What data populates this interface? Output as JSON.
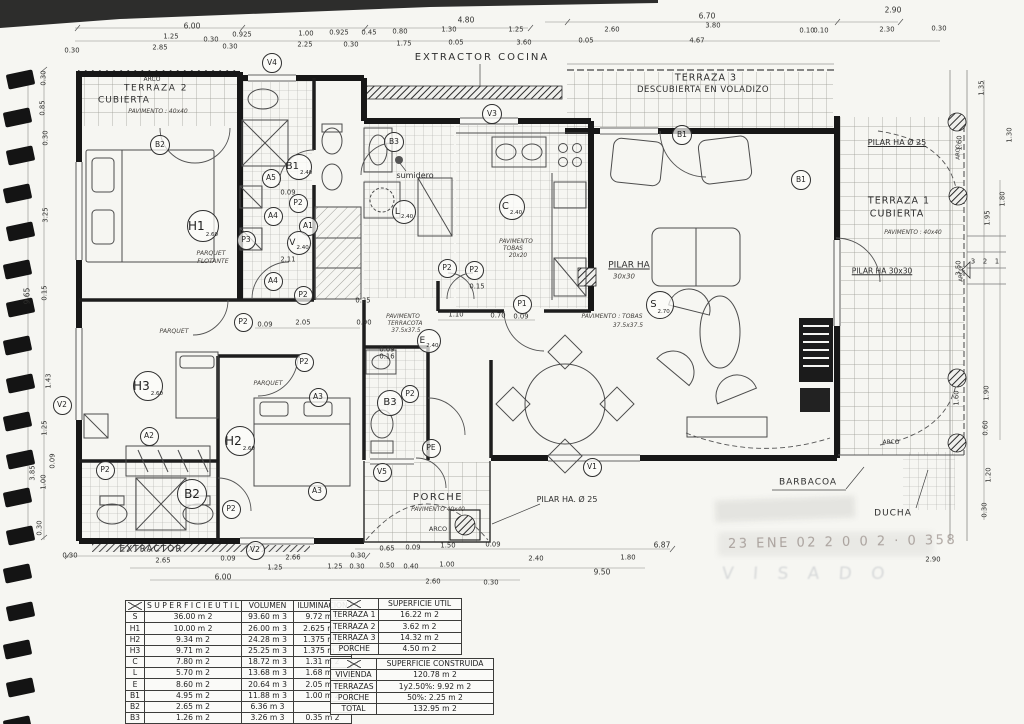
{
  "colors": {
    "paper": "#f6f6f2",
    "ink": "#2a2a2a",
    "stamp_date": "#857872",
    "stamp_visado": "#808896"
  },
  "stamp": {
    "line1": "23 ENE 02  2 0 0 2 · 0 358",
    "line2": "V I S A D O"
  },
  "plan": {
    "labels": [
      {
        "t": "ARCO",
        "x": 152,
        "y": 80,
        "s": 6
      },
      {
        "t": "TERRAZA 2",
        "x": 156,
        "y": 89,
        "s": 9,
        "sp": 1.5
      },
      {
        "t": "CUBIERTA",
        "x": 124,
        "y": 101,
        "s": 9,
        "sp": 1
      },
      {
        "t": "PAVIMENTO : 40x40",
        "x": 158,
        "y": 112,
        "s": 6,
        "i": 1
      },
      {
        "t": "EXTRACTOR COCINA",
        "x": 482,
        "y": 58,
        "s": 10,
        "sp": 2
      },
      {
        "t": "TERRAZA 3",
        "x": 706,
        "y": 78,
        "s": 9.5,
        "sp": 1
      },
      {
        "t": "DESCUBIERTA EN VOLADIZO",
        "x": 703,
        "y": 90,
        "s": 8.5,
        "sp": 0.5
      },
      {
        "t": "PILAR HA Ø 25",
        "x": 897,
        "y": 143,
        "s": 8,
        "u": 1
      },
      {
        "t": "TERRAZA 1",
        "x": 899,
        "y": 201,
        "s": 9.5,
        "sp": 1
      },
      {
        "t": "CUBIERTA",
        "x": 897,
        "y": 214,
        "s": 9.5,
        "sp": 1
      },
      {
        "t": "PAVIMENTO : 40x40",
        "x": 913,
        "y": 234,
        "s": 5.8,
        "i": 1
      },
      {
        "t": "PILAR HA 30x30",
        "x": 882,
        "y": 271,
        "s": 7.5,
        "u": 1
      },
      {
        "t": "PILAR HA",
        "x": 629,
        "y": 266,
        "s": 9,
        "u": 1
      },
      {
        "t": "30x30",
        "x": 624,
        "y": 277,
        "s": 7,
        "i": 1
      },
      {
        "t": "PAVIMENTO : TOBAS",
        "x": 612,
        "y": 317,
        "s": 6,
        "i": 1
      },
      {
        "t": "37.5x37.5",
        "x": 628,
        "y": 326,
        "s": 6,
        "i": 1
      },
      {
        "t": "sumidero",
        "x": 415,
        "y": 176,
        "s": 8
      },
      {
        "t": "PARQUET",
        "x": 211,
        "y": 254,
        "s": 6.2,
        "i": 1
      },
      {
        "t": "FLOTANTE",
        "x": 213,
        "y": 262,
        "s": 6.2,
        "i": 1
      },
      {
        "t": "PARQUET",
        "x": 174,
        "y": 332,
        "s": 6.2,
        "i": 1
      },
      {
        "t": "PARQUET",
        "x": 268,
        "y": 384,
        "s": 6.2,
        "i": 1
      },
      {
        "t": "PAVIMENTO",
        "x": 403,
        "y": 318,
        "s": 5.8,
        "i": 1
      },
      {
        "t": "TERRACOTA",
        "x": 405,
        "y": 325,
        "s": 5.8,
        "i": 1
      },
      {
        "t": "37.5x37.5",
        "x": 406,
        "y": 332,
        "s": 5.8,
        "i": 1
      },
      {
        "t": "PAVIMENTO",
        "x": 516,
        "y": 243,
        "s": 5.8,
        "i": 1
      },
      {
        "t": "TOBAS",
        "x": 513,
        "y": 250,
        "s": 5.8,
        "i": 1
      },
      {
        "t": "20x20",
        "x": 518,
        "y": 257,
        "s": 5.8,
        "i": 1
      },
      {
        "t": "EXTRACTOR",
        "x": 151,
        "y": 550,
        "s": 9,
        "sp": 1
      },
      {
        "t": "PORCHE",
        "x": 438,
        "y": 498,
        "s": 10,
        "sp": 1.5
      },
      {
        "t": "PAVIMENTO  40x40",
        "x": 438,
        "y": 511,
        "s": 5.8,
        "i": 1
      },
      {
        "t": "ARCO",
        "x": 438,
        "y": 529,
        "s": 6.5
      },
      {
        "t": "PILAR HA. Ø 25",
        "x": 567,
        "y": 500,
        "s": 8
      },
      {
        "t": "BARBACOA",
        "x": 808,
        "y": 483,
        "s": 9,
        "sp": 1
      },
      {
        "t": "DUCHA",
        "x": 893,
        "y": 514,
        "s": 9,
        "sp": 1
      },
      {
        "t": "ARCO",
        "x": 891,
        "y": 443,
        "s": 6
      },
      {
        "t": "ARCO",
        "x": 959,
        "y": 152,
        "s": 5.5,
        "r": 1
      },
      {
        "t": "ARCO",
        "x": 962,
        "y": 274,
        "s": 5.5,
        "r": 1
      },
      {
        "t": "3",
        "x": 973,
        "y": 262,
        "s": 7
      },
      {
        "t": "2",
        "x": 985,
        "y": 262,
        "s": 7
      },
      {
        "t": "1",
        "x": 997,
        "y": 262,
        "s": 7
      }
    ],
    "circles": [
      {
        "l": "V4",
        "x": 272,
        "y": 63,
        "d": 20
      },
      {
        "l": "V3",
        "x": 492,
        "y": 114,
        "d": 20
      },
      {
        "l": "B3",
        "x": 394,
        "y": 142,
        "d": 20
      },
      {
        "l": "B2",
        "x": 160,
        "y": 145,
        "d": 20
      },
      {
        "l": "B1",
        "s": "2.40",
        "x": 299,
        "y": 167,
        "d": 26
      },
      {
        "l": "A5",
        "x": 271,
        "y": 178,
        "d": 19
      },
      {
        "l": "P2",
        "x": 298,
        "y": 203,
        "d": 19
      },
      {
        "l": "A4",
        "x": 273,
        "y": 216,
        "d": 19
      },
      {
        "l": "H1",
        "s": "2.60",
        "x": 203,
        "y": 226,
        "d": 32
      },
      {
        "l": "A1",
        "x": 308,
        "y": 226,
        "d": 19
      },
      {
        "l": "P3",
        "x": 246,
        "y": 240,
        "d": 19
      },
      {
        "l": "V",
        "s": "2.40",
        "x": 299,
        "y": 243,
        "d": 24
      },
      {
        "l": "L",
        "s": "2.40",
        "x": 404,
        "y": 212,
        "d": 24
      },
      {
        "l": "C",
        "s": "2.40",
        "x": 512,
        "y": 207,
        "d": 26
      },
      {
        "l": "A4",
        "x": 273,
        "y": 281,
        "d": 19
      },
      {
        "l": "P2",
        "x": 303,
        "y": 295,
        "d": 19
      },
      {
        "l": "P2",
        "x": 243,
        "y": 322,
        "d": 19
      },
      {
        "l": "P2",
        "x": 447,
        "y": 268,
        "d": 19
      },
      {
        "l": "P2",
        "x": 474,
        "y": 270,
        "d": 19
      },
      {
        "l": "P1",
        "x": 522,
        "y": 304,
        "d": 19
      },
      {
        "l": "S",
        "s": "2.70",
        "x": 660,
        "y": 305,
        "d": 28
      },
      {
        "l": "E",
        "s": "2.40",
        "x": 429,
        "y": 341,
        "d": 24
      },
      {
        "l": "P2",
        "x": 304,
        "y": 362,
        "d": 19
      },
      {
        "l": "A3",
        "x": 318,
        "y": 397,
        "d": 19
      },
      {
        "l": "H3",
        "s": "2.60",
        "x": 148,
        "y": 386,
        "d": 30
      },
      {
        "l": "B3",
        "x": 390,
        "y": 403,
        "d": 26
      },
      {
        "l": "P2",
        "x": 410,
        "y": 394,
        "d": 18
      },
      {
        "l": "H2",
        "s": "2.60",
        "x": 240,
        "y": 441,
        "d": 30
      },
      {
        "l": "A2",
        "x": 149,
        "y": 436,
        "d": 19
      },
      {
        "l": "PE",
        "x": 431,
        "y": 448,
        "d": 19
      },
      {
        "l": "P2",
        "x": 105,
        "y": 470,
        "d": 19
      },
      {
        "l": "A3",
        "x": 317,
        "y": 491,
        "d": 19
      },
      {
        "l": "B2",
        "x": 192,
        "y": 494,
        "d": 30
      },
      {
        "l": "P2",
        "x": 231,
        "y": 509,
        "d": 19
      },
      {
        "l": "V5",
        "x": 382,
        "y": 472,
        "d": 19
      },
      {
        "l": "V1",
        "x": 592,
        "y": 467,
        "d": 19
      },
      {
        "l": "V2",
        "x": 62,
        "y": 405,
        "d": 19
      },
      {
        "l": "V2",
        "x": 255,
        "y": 550,
        "d": 19
      },
      {
        "l": "B1",
        "x": 682,
        "y": 135,
        "d": 20
      },
      {
        "l": "B1",
        "x": 801,
        "y": 180,
        "d": 20
      }
    ]
  },
  "dims": {
    "top": [
      {
        "t": "6.00",
        "x": 192,
        "y": 26,
        "s": 7.5
      },
      {
        "t": "4.80",
        "x": 466,
        "y": 20,
        "s": 7.5
      },
      {
        "t": "6.70",
        "x": 707,
        "y": 16,
        "s": 7.5
      },
      {
        "t": "2.90",
        "x": 893,
        "y": 10,
        "s": 7.5
      },
      {
        "t": "1.25",
        "x": 171,
        "y": 37
      },
      {
        "t": "0.30",
        "x": 211,
        "y": 40
      },
      {
        "t": "0.925",
        "x": 242,
        "y": 35
      },
      {
        "t": "1.00",
        "x": 306,
        "y": 34
      },
      {
        "t": "0.925",
        "x": 339,
        "y": 33
      },
      {
        "t": "0.45",
        "x": 369,
        "y": 33
      },
      {
        "t": "0.80",
        "x": 400,
        "y": 32
      },
      {
        "t": "1.30",
        "x": 449,
        "y": 30
      },
      {
        "t": "1.25",
        "x": 516,
        "y": 30
      },
      {
        "t": "2.60",
        "x": 612,
        "y": 30
      },
      {
        "t": "3.80",
        "x": 713,
        "y": 26
      },
      {
        "t": "0.10",
        "x": 807,
        "y": 31
      },
      {
        "t": "0.10",
        "x": 821,
        "y": 31
      },
      {
        "t": "2.30",
        "x": 887,
        "y": 30
      },
      {
        "t": "0.30",
        "x": 939,
        "y": 29
      },
      {
        "t": "0.30",
        "x": 72,
        "y": 51
      },
      {
        "t": "2.85",
        "x": 160,
        "y": 48
      },
      {
        "t": "0.30",
        "x": 230,
        "y": 47
      },
      {
        "t": "2.25",
        "x": 305,
        "y": 45
      },
      {
        "t": "0.30",
        "x": 351,
        "y": 45
      },
      {
        "t": "1.75",
        "x": 404,
        "y": 44
      },
      {
        "t": "0.05",
        "x": 456,
        "y": 43
      },
      {
        "t": "3.60",
        "x": 524,
        "y": 43
      },
      {
        "t": "0.05",
        "x": 586,
        "y": 41
      },
      {
        "t": "4.67",
        "x": 697,
        "y": 41
      }
    ],
    "bottom": [
      {
        "t": "0.30",
        "x": 70,
        "y": 556
      },
      {
        "t": "2.65",
        "x": 163,
        "y": 561
      },
      {
        "t": "0.09",
        "x": 228,
        "y": 559
      },
      {
        "t": "2.66",
        "x": 293,
        "y": 558
      },
      {
        "t": "0.30",
        "x": 358,
        "y": 556
      },
      {
        "t": "0.65",
        "x": 387,
        "y": 549
      },
      {
        "t": "0.09",
        "x": 413,
        "y": 548
      },
      {
        "t": "1.50",
        "x": 448,
        "y": 546
      },
      {
        "t": "0.09",
        "x": 493,
        "y": 545
      },
      {
        "t": "2.40",
        "x": 536,
        "y": 559
      },
      {
        "t": "1.80",
        "x": 628,
        "y": 558
      },
      {
        "t": "6.87",
        "x": 662,
        "y": 545,
        "s": 7.5
      },
      {
        "t": "1.25",
        "x": 275,
        "y": 568
      },
      {
        "t": "1.25",
        "x": 335,
        "y": 567
      },
      {
        "t": "0.30",
        "x": 357,
        "y": 567
      },
      {
        "t": "0.50",
        "x": 387,
        "y": 566
      },
      {
        "t": "0.40",
        "x": 411,
        "y": 567
      },
      {
        "t": "1.00",
        "x": 447,
        "y": 565
      },
      {
        "t": "9.50",
        "x": 602,
        "y": 572,
        "s": 7.5
      },
      {
        "t": "6.00",
        "x": 223,
        "y": 577,
        "s": 7.5
      },
      {
        "t": "2.60",
        "x": 433,
        "y": 582
      },
      {
        "t": "0.30",
        "x": 491,
        "y": 583
      },
      {
        "t": "2.90",
        "x": 933,
        "y": 560
      }
    ],
    "left": [
      {
        "t": "0.30",
        "x": 44,
        "y": 78
      },
      {
        "t": "0.85",
        "x": 43,
        "y": 108
      },
      {
        "t": "0.30",
        "x": 46,
        "y": 138
      },
      {
        "t": "3.25",
        "x": 46,
        "y": 215
      },
      {
        "t": "0.15",
        "x": 45,
        "y": 293
      },
      {
        "t": "9.65",
        "x": 27,
        "y": 296,
        "s": 7.5
      },
      {
        "t": "1.43",
        "x": 49,
        "y": 381
      },
      {
        "t": "1.25",
        "x": 45,
        "y": 428
      },
      {
        "t": "0.09",
        "x": 53,
        "y": 461
      },
      {
        "t": "3.85",
        "x": 33,
        "y": 473
      },
      {
        "t": "1.00",
        "x": 44,
        "y": 482
      },
      {
        "t": "0.30",
        "x": 40,
        "y": 528
      }
    ],
    "right": [
      {
        "t": "1.35",
        "x": 982,
        "y": 88
      },
      {
        "t": "1.60",
        "x": 960,
        "y": 143
      },
      {
        "t": "1.30",
        "x": 1010,
        "y": 135
      },
      {
        "t": "1.80",
        "x": 1003,
        "y": 199
      },
      {
        "t": "1.95",
        "x": 988,
        "y": 218
      },
      {
        "t": "3.50",
        "x": 959,
        "y": 268
      },
      {
        "t": "1.90",
        "x": 987,
        "y": 393
      },
      {
        "t": "1.60",
        "x": 957,
        "y": 398
      },
      {
        "t": "0.60",
        "x": 986,
        "y": 428
      },
      {
        "t": "1.20",
        "x": 989,
        "y": 475
      },
      {
        "t": "0.30",
        "x": 985,
        "y": 510
      }
    ],
    "inner": [
      {
        "t": "2.11",
        "x": 288,
        "y": 260
      },
      {
        "t": "0.09",
        "x": 288,
        "y": 193
      },
      {
        "t": "0.09",
        "x": 265,
        "y": 325
      },
      {
        "t": "2.05",
        "x": 303,
        "y": 323
      },
      {
        "t": "0.90",
        "x": 364,
        "y": 323
      },
      {
        "t": "0.25",
        "x": 363,
        "y": 301
      },
      {
        "t": "1.10",
        "x": 456,
        "y": 315
      },
      {
        "t": "0.70",
        "x": 498,
        "y": 316
      },
      {
        "t": "0.09",
        "x": 521,
        "y": 317
      },
      {
        "t": "0.15",
        "x": 477,
        "y": 287
      },
      {
        "t": "0.09",
        "x": 387,
        "y": 350
      },
      {
        "t": "0.16",
        "x": 387,
        "y": 357
      }
    ]
  },
  "tables": {
    "t1": {
      "x": 125,
      "y": 600,
      "cols": [
        18,
        80,
        52,
        58
      ],
      "headers": [
        "S U P E R F I C I E  U T I L",
        "VOLUMEN",
        "ILUMINACION"
      ],
      "rows": [
        [
          "S",
          "36.00  m 2",
          "93.60 m 3",
          "9.72  m 2"
        ],
        [
          "H1",
          "10.00  m 2",
          "26.00 m 3",
          "2.625 m 2"
        ],
        [
          "H2",
          "9.34  m 2",
          "24.28 m 3",
          "1.375 m 2"
        ],
        [
          "H3",
          "9.71  m 2",
          "25.25 m 3",
          "1.375 m 2"
        ],
        [
          "C",
          "7.80  m 2",
          "18.72 m 3",
          "1.31  m 2"
        ],
        [
          "L",
          "5.70  m 2",
          "13.68 m 3",
          "1.68  m 2"
        ],
        [
          "E",
          "8.60  m 2",
          "20.64 m 3",
          "2.05  m 2"
        ],
        [
          "B1",
          "4.95  m 2",
          "11.88 m 3",
          "1.00  m 2"
        ],
        [
          "B2",
          "2.65  m 2",
          "6.36 m 3",
          ""
        ],
        [
          "B3",
          "1.26  m 2",
          "3.26 m 3",
          "0.35  m 2"
        ]
      ]
    },
    "t2": {
      "x": 330,
      "y": 598,
      "cols": [
        44,
        83
      ],
      "title": "SUPERFICIE UTIL",
      "rows": [
        [
          "TERRAZA 1",
          "16.22  m 2"
        ],
        [
          "TERRAZA 2",
          "3.62  m 2"
        ],
        [
          "TERRAZA 3",
          "14.32  m 2"
        ],
        [
          "PORCHE",
          "4.50  m 2"
        ]
      ]
    },
    "t3": {
      "x": 330,
      "y": 658,
      "cols": [
        46,
        117
      ],
      "title": "SUPERFICIE CONSTRUIDA",
      "rows": [
        [
          "VIVIENDA",
          "120.78  m 2"
        ],
        [
          "TERRAZAS",
          "1y2.50%:   9.92  m 2"
        ],
        [
          "PORCHE",
          "50%:   2.25  m 2"
        ],
        [
          "TOTAL",
          "132.95 m 2"
        ]
      ]
    }
  }
}
